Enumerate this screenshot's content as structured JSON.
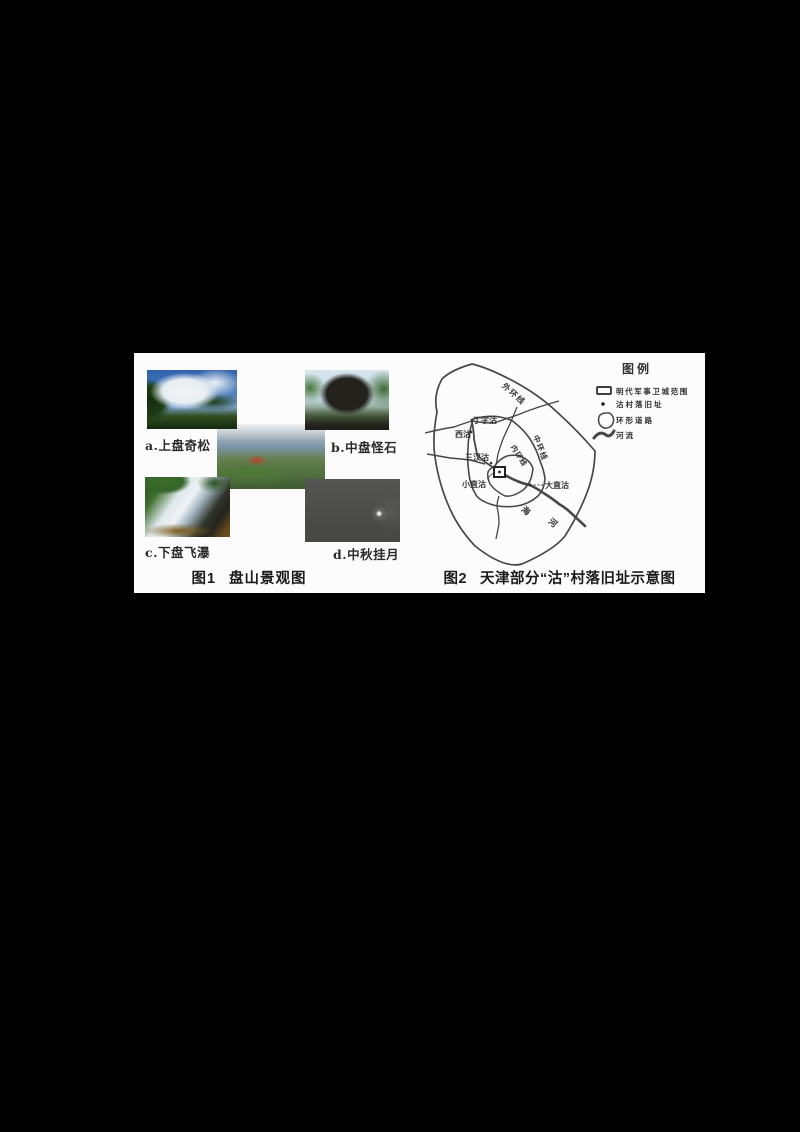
{
  "page": {
    "background_color": "#000000",
    "panel_background": "#fcfcfc"
  },
  "figure1": {
    "caption_label": "图1",
    "caption_title": "盘山景观图",
    "photo_a_caption": "a.上盘奇松",
    "photo_b_caption": "b.中盘怪石",
    "photo_c_caption": "c.下盘飞瀑",
    "photo_d_caption": "d.中秋挂月"
  },
  "figure2": {
    "caption_label": "图2",
    "caption_title": "天津部分“沽”村落旧址示意图",
    "map_labels": {
      "outer_ring": "外环线",
      "middle_ring": "中环线",
      "inner_ring": "内环线",
      "dingzigu": "丁字沽",
      "xigu": "西沽",
      "sanchagu": "三汊沽",
      "xiaozhigu": "小直沽",
      "dazhigu": "大直沽",
      "river_char_1": "海",
      "river_char_2": "河"
    },
    "legend": {
      "title": "图例",
      "items": [
        {
          "symbol": "rectangle-outline-icon",
          "label": "明代军事卫城范围"
        },
        {
          "symbol": "dot-icon",
          "label": "沽村落旧址"
        },
        {
          "symbol": "ring-loop-icon",
          "label": "环形道路"
        },
        {
          "symbol": "thick-river-line-icon",
          "label": "河流"
        }
      ]
    },
    "line_color": "#474747"
  }
}
